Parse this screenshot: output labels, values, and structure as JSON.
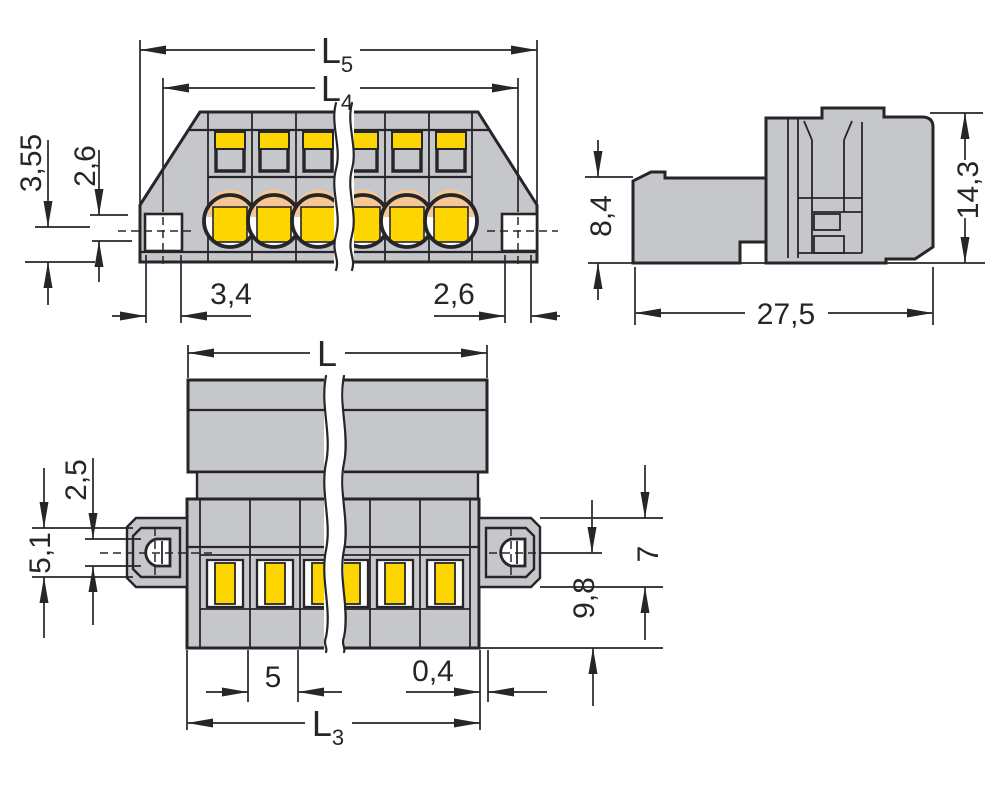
{
  "colors": {
    "background": "#ffffff",
    "body_gray": "#c6c7ca",
    "line": "#26262a",
    "accent_yellow": "#fdd501",
    "accent_peach": "#f6c795"
  },
  "dims": {
    "front_overall": {
      "main": "L",
      "sub": "5"
    },
    "front_inner": {
      "main": "L",
      "sub": "4"
    },
    "front_left_outer": "3,55",
    "front_left_inner": "2,6",
    "front_flange_left": "3,4",
    "front_flange_right": "2,6",
    "side_front_height": "8,4",
    "side_total_height": "14,3",
    "side_depth": "27,5",
    "bottom_length": {
      "main": "L",
      "sub": ""
    },
    "bottom_hole_offset": "2,5",
    "bottom_slot_height": "5,1",
    "bottom_flange_height": "7",
    "bottom_center_to_edge": "9,8",
    "bottom_pole_pitch": "5",
    "bottom_edge_gap": "0,4",
    "bottom_body_length": {
      "main": "L",
      "sub": "3"
    }
  }
}
